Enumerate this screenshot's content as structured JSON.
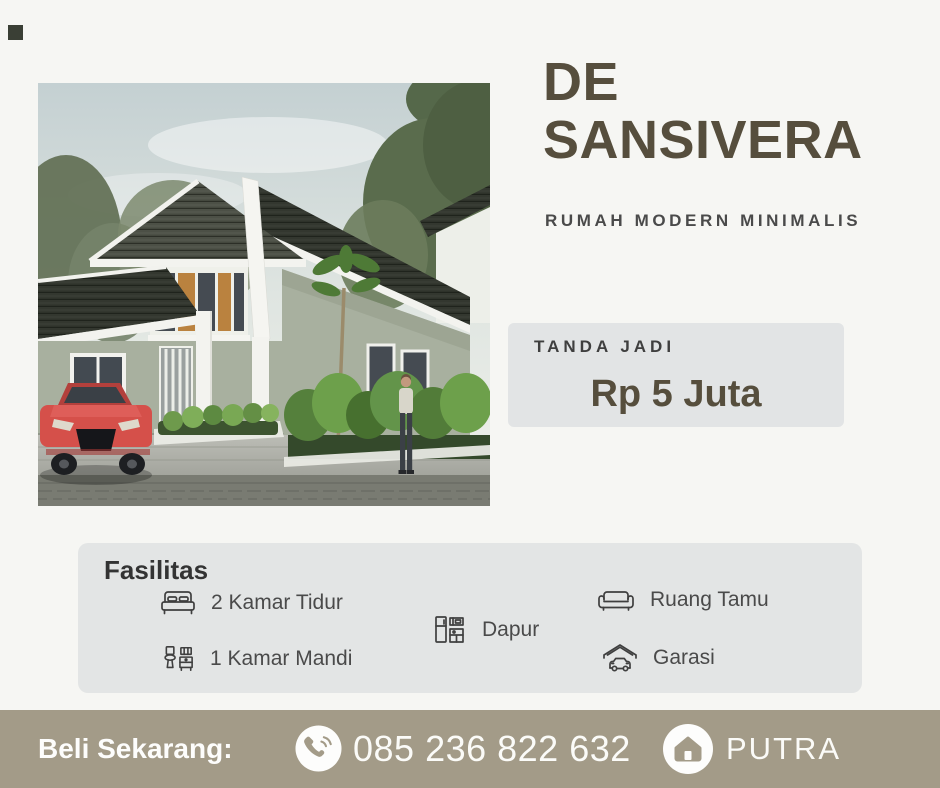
{
  "poster": {
    "title": "DE\nSANSIVERA",
    "subtitle": "RUMAH MODERN MINIMALIS"
  },
  "booking": {
    "label": "TANDA JADI",
    "price": "Rp 5 Juta"
  },
  "facilities": {
    "heading": "Fasilitas",
    "items": [
      {
        "icon": "bed-icon",
        "label": "2 Kamar Tidur"
      },
      {
        "icon": "bathroom-icon",
        "label": "1 Kamar Mandi"
      },
      {
        "icon": "kitchen-icon",
        "label": "Dapur"
      },
      {
        "icon": "sofa-icon",
        "label": "Ruang Tamu"
      },
      {
        "icon": "garage-icon",
        "label": "Garasi"
      }
    ]
  },
  "footer": {
    "cta": "Beli Sekarang:",
    "phone": "085 236 822 632",
    "brand_name": "PUTRA"
  },
  "colors": {
    "background": "#f6f6f3",
    "panel": "#e3e4e5",
    "accent_brown": "#564e3d",
    "footer_bar": "#a39b88",
    "text_dark": "#3d3d3d",
    "text_gray": "#4a4a4a",
    "white": "#fdfdfc"
  }
}
